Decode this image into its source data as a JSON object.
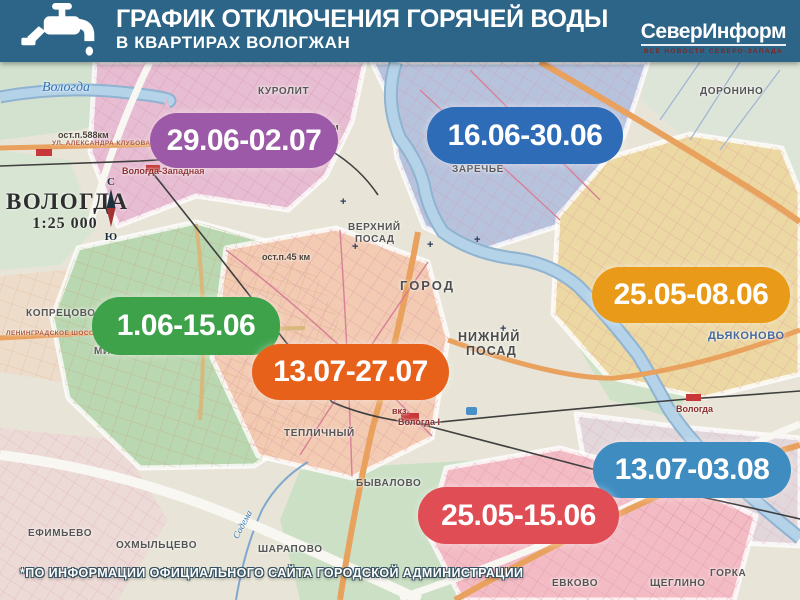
{
  "header": {
    "title_line1": "ГРАФИК ОТКЛЮЧЕНИЯ ГОРЯЧЕЙ ВОДЫ",
    "title_line2": "В КВАРТИРАХ ВОЛОГЖАН",
    "bg_color": "#2c6587",
    "logo": {
      "name": "СеверИнформ",
      "tagline": "ВСЕ НОВОСТИ СЕВЕРО-ЗАПАДА"
    }
  },
  "map": {
    "city_label": "ВОЛОГДА",
    "scale_label": "1:25 000",
    "compass": {
      "north": "С",
      "south": "Ю"
    }
  },
  "badges": [
    {
      "label": "29.06-02.07",
      "color": "#9b59a7",
      "x": 150,
      "y": 113,
      "w": 188,
      "h": 55
    },
    {
      "label": "16.06-30.06",
      "color": "#2e6cb8",
      "x": 427,
      "y": 107,
      "w": 196,
      "h": 57
    },
    {
      "label": "25.05-08.06",
      "color": "#e89a18",
      "x": 592,
      "y": 267,
      "w": 198,
      "h": 56
    },
    {
      "label": "1.06-15.06",
      "color": "#3ea24b",
      "x": 92,
      "y": 297,
      "w": 188,
      "h": 58
    },
    {
      "label": "13.07-27.07",
      "color": "#e8611b",
      "x": 252,
      "y": 344,
      "w": 197,
      "h": 56
    },
    {
      "label": "13.07-03.08",
      "color": "#3f8dc0",
      "x": 593,
      "y": 442,
      "w": 198,
      "h": 56
    },
    {
      "label": "25.05-15.06",
      "color": "#e14d55",
      "x": 418,
      "y": 487,
      "w": 201,
      "h": 57
    }
  ],
  "map_labels": [
    {
      "text": "Вологда",
      "x": 42,
      "y": 80,
      "cls": "river"
    },
    {
      "text": "КУРОЛИТ",
      "x": 258,
      "y": 86,
      "cls": "dsm"
    },
    {
      "text": "ост.п.588км",
      "x": 58,
      "y": 130,
      "cls": "stop"
    },
    {
      "text": "ост.п.499км",
      "x": 288,
      "y": 122,
      "cls": "stop"
    },
    {
      "text": "Вологда-Западная",
      "x": 122,
      "y": 166,
      "cls": "station"
    },
    {
      "text": "УЛ. АЛЕКСАНДРА КЛУБОВА",
      "x": 52,
      "y": 140,
      "cls": "str"
    },
    {
      "text": "ДОРОНИНО",
      "x": 700,
      "y": 86,
      "cls": "dsm"
    },
    {
      "text": "ЗАРЕЧЬЕ",
      "x": 452,
      "y": 164,
      "cls": "dsm"
    },
    {
      "text": "ВЕРХНИЙ",
      "x": 348,
      "y": 222,
      "cls": "dsm"
    },
    {
      "text": "ПОСАД",
      "x": 355,
      "y": 234,
      "cls": "dsm"
    },
    {
      "text": "ост.п.45 км",
      "x": 262,
      "y": 252,
      "cls": "stop"
    },
    {
      "text": "ГОРОД",
      "x": 400,
      "y": 278,
      "cls": "dst"
    },
    {
      "text": "КОПРЕЦОВО",
      "x": 26,
      "y": 308,
      "cls": "dsm"
    },
    {
      "text": "ЛЕНИНГРАДСКОЕ ШОССЕ",
      "x": 6,
      "y": 330,
      "cls": "str"
    },
    {
      "text": "МИКРОРАЙОН ГПЗ",
      "x": 94,
      "y": 346,
      "cls": "dsm"
    },
    {
      "text": "НИЖНИЙ",
      "x": 458,
      "y": 330,
      "cls": "dst2"
    },
    {
      "text": "ПОСАД",
      "x": 466,
      "y": 344,
      "cls": "dst2"
    },
    {
      "text": "ДЬЯКОНОВО",
      "x": 708,
      "y": 330,
      "cls": "dbl"
    },
    {
      "text": "ТЕПЛИЧНЫЙ",
      "x": 284,
      "y": 428,
      "cls": "dsm"
    },
    {
      "text": "вкз.",
      "x": 392,
      "y": 406,
      "cls": "station"
    },
    {
      "text": "Вологда I",
      "x": 398,
      "y": 417,
      "cls": "station"
    },
    {
      "text": "Вологда",
      "x": 676,
      "y": 404,
      "cls": "station"
    },
    {
      "text": "БЫВАЛОВО",
      "x": 356,
      "y": 478,
      "cls": "dsm"
    },
    {
      "text": "НОВЫЙ",
      "x": 492,
      "y": 532,
      "cls": "dsm"
    },
    {
      "text": "ЕВКОВО",
      "x": 552,
      "y": 578,
      "cls": "dsm"
    },
    {
      "text": "ЩЕГЛИНО",
      "x": 650,
      "y": 578,
      "cls": "dsm"
    },
    {
      "text": "ГОРКА",
      "x": 710,
      "y": 568,
      "cls": "dsm"
    },
    {
      "text": "ЕФИМЬЕВО",
      "x": 28,
      "y": 528,
      "cls": "dsm"
    },
    {
      "text": "ОХМЫЛЬЦЕВО",
      "x": 116,
      "y": 540,
      "cls": "dsm"
    },
    {
      "text": "ШАРАПОВО",
      "x": 258,
      "y": 544,
      "cls": "dsm"
    },
    {
      "text": "Содема",
      "x": 228,
      "y": 520,
      "cls": "rsm",
      "rot": -62
    }
  ],
  "footer": {
    "note": "*ПО ИНФОРМАЦИИ ОФИЦИАЛЬНОГО САЙТА ГОРОДСКОЙ АДМИНИСТРАЦИИ"
  }
}
